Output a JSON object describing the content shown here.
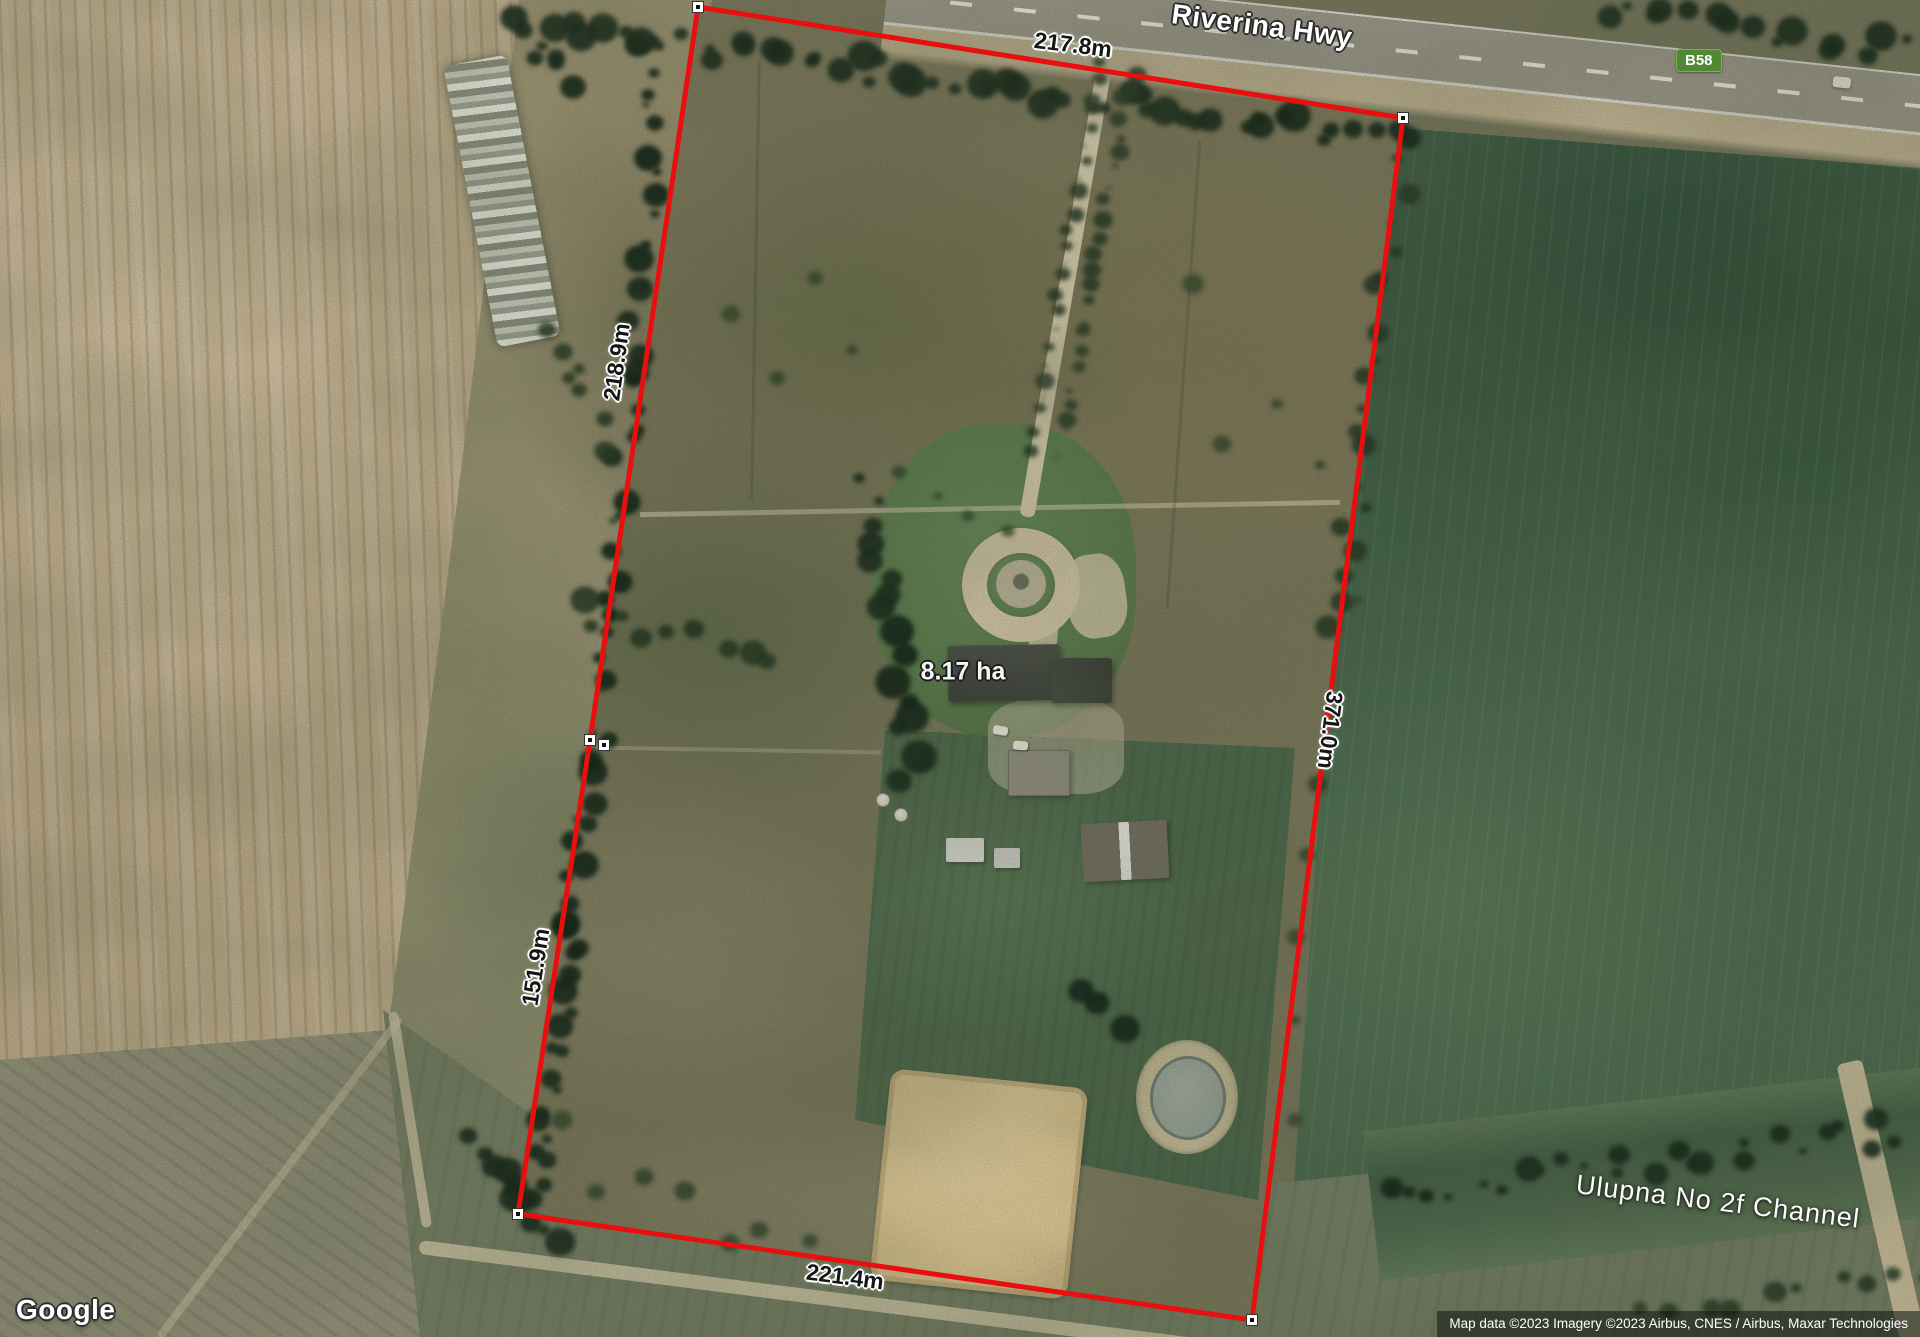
{
  "map": {
    "provider_logo": "Google",
    "attribution": "Map data ©2023 Imagery ©2023 Airbus, CNES / Airbus, Maxar Technologies",
    "road_label": "Riverina Hwy",
    "route_badge": "B58",
    "channel_label": "Ulupna No 2f Channel"
  },
  "measurement": {
    "area_label": "8.17 ha",
    "boundary_color": "#ea0f0f",
    "sides": {
      "top": "217.8m",
      "left_upper": "218.9m",
      "left_lower": "151.9m",
      "right": "371.0m",
      "bottom": "221.4m"
    },
    "vertices": [
      [
        698,
        7
      ],
      [
        1403,
        118
      ],
      [
        1252,
        1320
      ],
      [
        518,
        1214
      ],
      [
        590,
        740
      ]
    ],
    "extra_markers": [
      [
        604,
        745
      ]
    ]
  }
}
